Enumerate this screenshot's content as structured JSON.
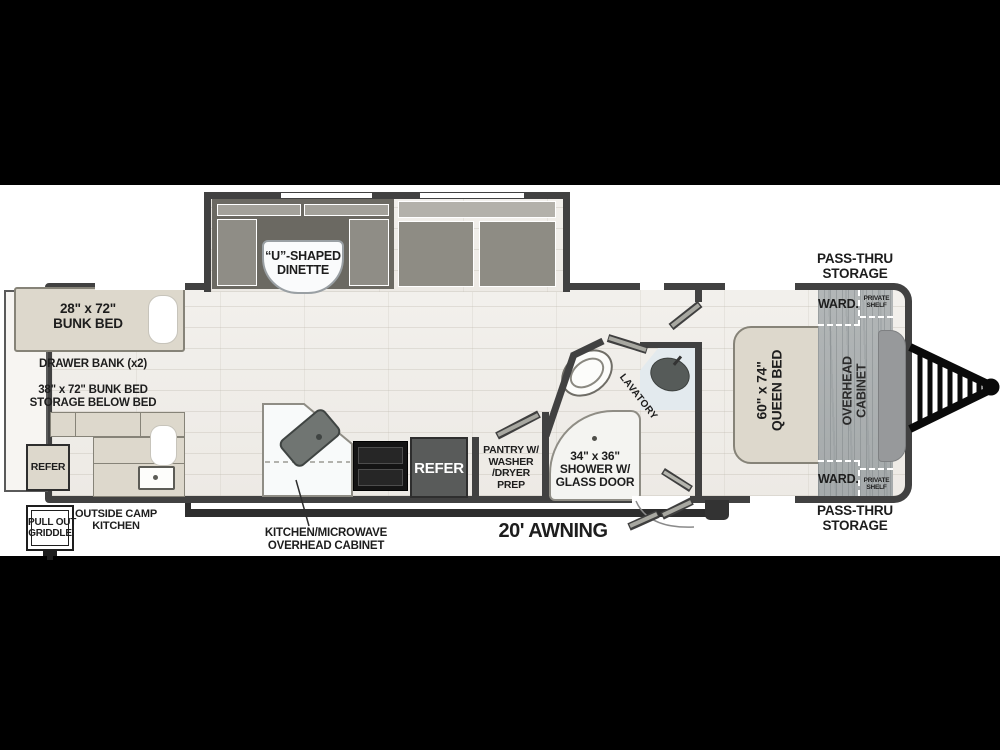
{
  "page": {
    "background": "#000000",
    "paper": "#ffffff"
  },
  "colors": {
    "wall": "#414141",
    "furniture_beige": "#ddd8cc",
    "bench_dark": "#6b6962",
    "cushion_gray": "#8f8d86",
    "refer_box": "#595b5a",
    "wood_cabinet_gray": "#adb2b3",
    "marble_white": "#f8fafa",
    "lavatory_counter": "#e3eaee",
    "basin_dark": "#565b59",
    "hitch_black": "#0a0a0a"
  },
  "labels": {
    "bunk_upper": [
      "28\" x 72\"",
      "BUNK BED"
    ],
    "drawer_bank": "DRAWER BANK (x2)",
    "bunk_lower": [
      "38\" x 72\" BUNK BED",
      "STORAGE BELOW BED"
    ],
    "outside_refrigerator": "REFER",
    "pull_out_griddle": [
      "PULL OUT",
      "GRIDDLE"
    ],
    "outside_camp_kitchen": [
      "OUTSIDE CAMP",
      "KITCHEN"
    ],
    "dinette": [
      "“U”-SHAPED",
      "DINETTE"
    ],
    "kitchen_overhead": [
      "KITCHEN/MICROWAVE",
      "OVERHEAD CABINET"
    ],
    "refrigerator": "REFER",
    "pantry": [
      "PANTRY W/",
      "WASHER",
      "/DRYER",
      "PREP"
    ],
    "shower": [
      "34\" x 36\"",
      "SHOWER W/",
      "GLASS DOOR"
    ],
    "lavatory": "LAVATORY",
    "awning": "20' AWNING",
    "queen_bed": [
      "60\" x 74\"",
      "QUEEN BED"
    ],
    "overhead_cabinet": [
      "OVERHEAD",
      "CABINET"
    ],
    "wardrobe_top": "WARD.",
    "wardrobe_bottom": "WARD.",
    "private_shelf_top": [
      "PRIVATE",
      "SHELF"
    ],
    "private_shelf_bottom": [
      "PRIVATE",
      "SHELF"
    ],
    "pass_thru_top": [
      "PASS-THRU",
      "STORAGE"
    ],
    "pass_thru_bottom": [
      "PASS-THRU",
      "STORAGE"
    ]
  }
}
